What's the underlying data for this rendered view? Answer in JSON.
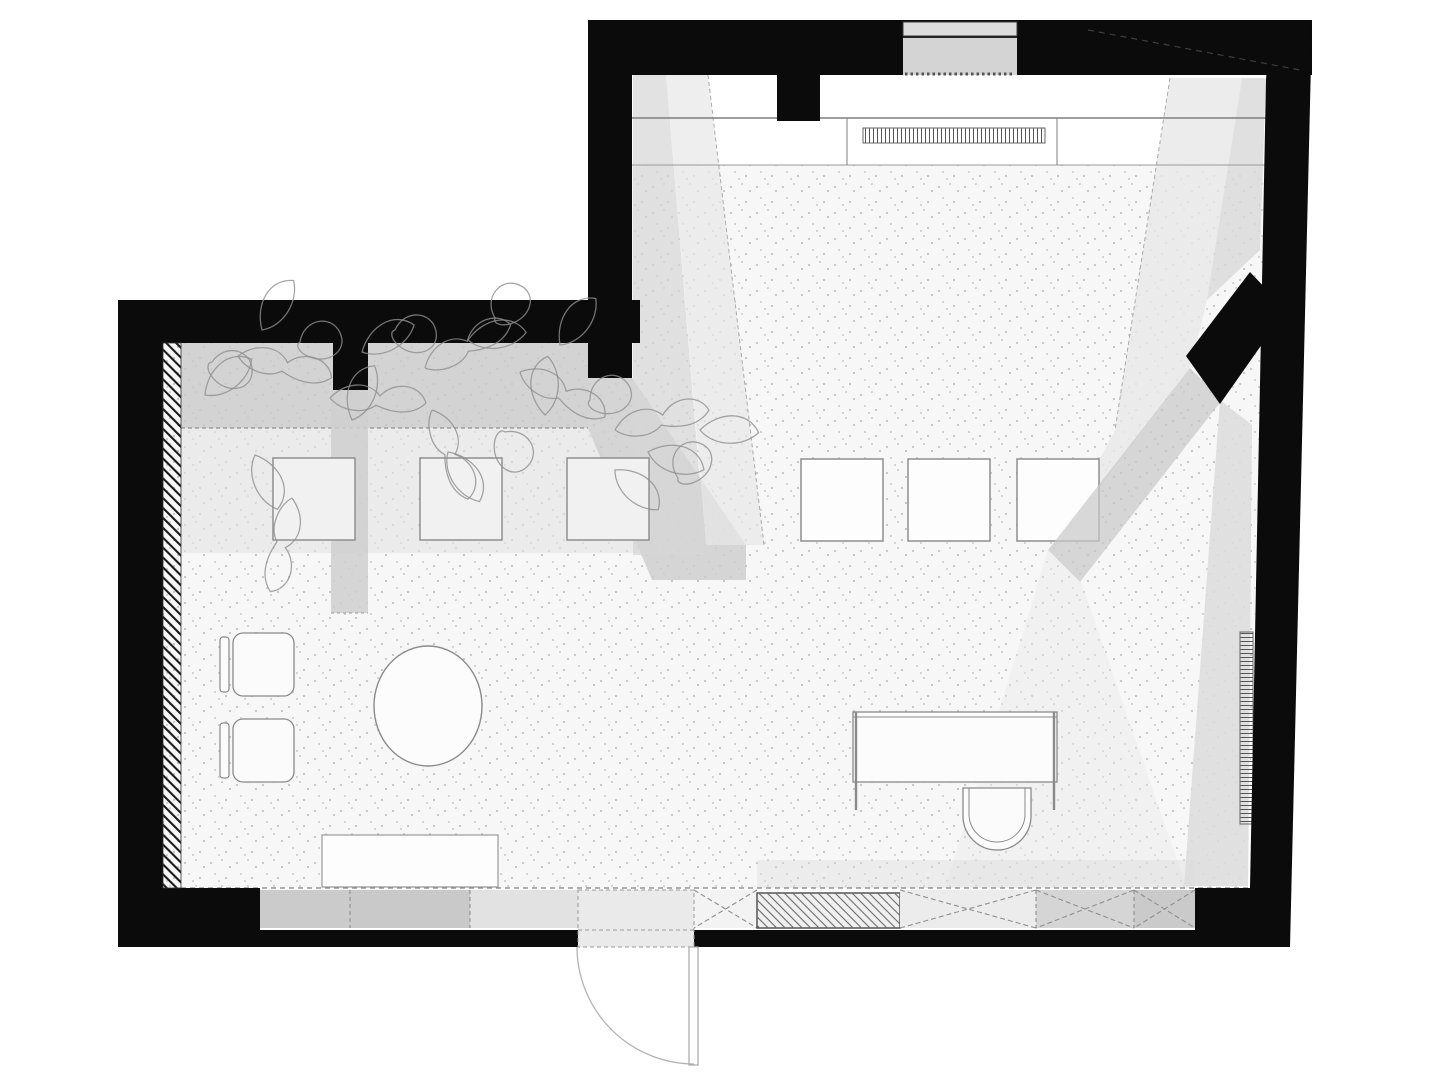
{
  "plan": {
    "title": "studio-floor-plan",
    "canvas": {
      "w": 1440,
      "h": 1080,
      "background": "#ffffff"
    },
    "colors": {
      "wall": "#0b0b0b",
      "floor_base": "#f7f7f7",
      "shadow_dark": "#c7c7c7",
      "shadow_mid": "#d5d5d5",
      "shadow_light": "#e7e7e7",
      "furniture_stroke": "#8a8a8a",
      "opening_gray": "#d4d4d4"
    },
    "leaves": {
      "shapes": {
        "leaf": "M0,0 C7,-15 24,-22 35,-11 C29,1 12,7 0,0 Z",
        "vine": "M0,0 C9,-11 23,-13 31,-4 C40,-15 56,-13 60,-2 C51,8 37,5 29,2 C21,9 7,7 0,0",
        "loop": "M0,0 C-4,-14 10,-24 20,-16 C30,-8 22,6 8,6 C2,6 -2,3 0,0 Z"
      },
      "stroke": "#8f8f8f",
      "items": [
        [
          205,
          395,
          -20,
          "leaf"
        ],
        [
          238,
          356,
          15,
          "vine"
        ],
        [
          262,
          330,
          -40,
          "leaf"
        ],
        [
          300,
          342,
          25,
          "loop"
        ],
        [
          330,
          398,
          5,
          "vine"
        ],
        [
          362,
          352,
          -10,
          "leaf"
        ],
        [
          395,
          330,
          40,
          "loop"
        ],
        [
          425,
          368,
          -25,
          "vine"
        ],
        [
          468,
          340,
          10,
          "leaf"
        ],
        [
          495,
          318,
          -15,
          "loop"
        ],
        [
          520,
          372,
          30,
          "vine"
        ],
        [
          560,
          345,
          -35,
          "leaf"
        ],
        [
          590,
          400,
          15,
          "loop"
        ],
        [
          615,
          430,
          -10,
          "vine"
        ],
        [
          648,
          452,
          35,
          "leaf"
        ],
        [
          678,
          478,
          -20,
          "loop"
        ],
        [
          255,
          455,
          85,
          "leaf"
        ],
        [
          292,
          498,
          105,
          "vine"
        ],
        [
          448,
          452,
          75,
          "leaf"
        ],
        [
          505,
          432,
          95,
          "loop"
        ],
        [
          615,
          470,
          60,
          "leaf"
        ],
        [
          700,
          430,
          20,
          "leaf"
        ],
        [
          212,
          362,
          50,
          "loop"
        ],
        [
          352,
          420,
          -50,
          "leaf"
        ],
        [
          432,
          410,
          70,
          "vine"
        ],
        [
          545,
          415,
          -70,
          "leaf"
        ]
      ]
    },
    "shapes": [
      {
        "n": "floor-base",
        "k": "poly",
        "p": "163,343 588,343 588,378 632,378 632,165 1266,165 1248,888 163,888",
        "f": "#f7f7f7"
      },
      {
        "n": "floor-stipple",
        "k": "poly",
        "p": "163,343 588,343 588,378 632,378 632,165 1266,165 1248,888 163,888",
        "f": "url(#dots)",
        "o": 0.6
      },
      {
        "n": "entry-counter-band",
        "k": "rect",
        "x": 632,
        "y": 75,
        "w": 636,
        "h": 90,
        "f": "#ffffff"
      },
      {
        "n": "shadow-left-mid-zone",
        "k": "poly",
        "p": "181,428 588,428 660,553 181,553",
        "f": "#e2e2e2",
        "o": 0.6
      },
      {
        "n": "planting-band",
        "k": "rect",
        "x": 181,
        "y": 343,
        "w": 407,
        "h": 85,
        "f": "#c9c9c9",
        "o": 0.8
      },
      {
        "n": "planting-band-tail",
        "k": "poly",
        "p": "588,378 632,378 746,545 746,580 652,580 588,428",
        "f": "#cccccc",
        "o": 0.8
      },
      {
        "n": "planting-band-edge",
        "k": "line",
        "x1": 181,
        "y1": 428,
        "x2": 588,
        "y2": 428,
        "s": "#8f8f8f",
        "sw": 1.2,
        "da": "4,3"
      },
      {
        "n": "pier-shadow",
        "k": "rect",
        "x": 331,
        "y": 390,
        "w": 37,
        "h": 223,
        "f": "#cfcfcf",
        "o": 0.85
      },
      {
        "n": "pier-shadow-edge",
        "k": "line",
        "x1": 331,
        "y1": 613,
        "x2": 368,
        "y2": 613,
        "s": "#999999",
        "sw": 1,
        "da": "3,3"
      },
      {
        "n": "light-band-left-dark",
        "k": "poly",
        "p": "633,75 666,75 706,555 633,555",
        "f": "#d5d5d5",
        "o": 0.7
      },
      {
        "n": "light-band-left",
        "k": "poly",
        "p": "666,75 708,75 764,545 706,545",
        "f": "#e7e7e7",
        "o": 0.7
      },
      {
        "n": "light-band-left-edge",
        "k": "line",
        "x1": 708,
        "y1": 75,
        "x2": 764,
        "y2": 545,
        "s": "#aaaaaa",
        "sw": 1,
        "da": "4,3"
      },
      {
        "n": "light-band-right",
        "k": "poly",
        "p": "1170,78 1242,78 1207,300 1190,368 1052,550 1115,430",
        "f": "#e7e7e7",
        "o": 0.8
      },
      {
        "n": "light-band-right-edge",
        "k": "line",
        "x1": 1170,
        "y1": 78,
        "x2": 1115,
        "y2": 430,
        "s": "#aaaaaa",
        "sw": 1,
        "da": "4,3"
      },
      {
        "n": "shadow-band-right-wall",
        "k": "poly",
        "p": "1242,78 1266,78 1260,250 1207,300",
        "f": "#d8d8d8",
        "o": 0.8
      },
      {
        "n": "shadow-right-lower",
        "k": "poly",
        "p": "1220,400 1252,425 1248,886 1184,886",
        "f": "#dcdcdc",
        "o": 0.85
      },
      {
        "n": "light-spill-bottom-right",
        "k": "poly",
        "p": "1048,550 1082,584 1186,886 946,886",
        "f": "#e9e9e9",
        "o": 0.45
      },
      {
        "n": "shadow-bottom-strip",
        "k": "rect",
        "x": 757,
        "y": 860,
        "w": 438,
        "h": 28,
        "f": "#dcdcdc",
        "o": 0.4
      },
      {
        "n": "counter-front-line",
        "k": "line",
        "x1": 632,
        "y1": 118,
        "x2": 1268,
        "y2": 118,
        "s": "#7e7e7e",
        "sw": 1.6
      },
      {
        "n": "floor-start-line",
        "k": "line",
        "x1": 632,
        "y1": 165,
        "x2": 1266,
        "y2": 165,
        "s": "#9a9a9a",
        "sw": 1.1
      },
      {
        "n": "counter-divider-left",
        "k": "line",
        "x1": 847,
        "y1": 118,
        "x2": 847,
        "y2": 165,
        "s": "#8a8a8a",
        "sw": 1.1
      },
      {
        "n": "counter-divider-right",
        "k": "line",
        "x1": 1057,
        "y1": 118,
        "x2": 1057,
        "y2": 165,
        "s": "#8a8a8a",
        "sw": 1.1
      },
      {
        "n": "radiator-top",
        "k": "rect",
        "x": 863,
        "y": 128,
        "w": 182,
        "h": 15,
        "f": "url(#vlines)",
        "s": "#666666",
        "sw": 1
      },
      {
        "n": "floor-edge-dashed",
        "k": "line",
        "x1": 181,
        "y1": 888,
        "x2": 1248,
        "y2": 888,
        "s": "#808080",
        "sw": 1.2,
        "da": "5,4"
      },
      {
        "n": "table-left-1",
        "k": "rect",
        "x": 273,
        "y": 458,
        "w": 82,
        "h": 82,
        "f": "#f1f1f1",
        "s": "#8f8f8f",
        "sw": 1.5
      },
      {
        "n": "table-left-2",
        "k": "rect",
        "x": 420,
        "y": 458,
        "w": 82,
        "h": 82,
        "f": "#f1f1f1",
        "s": "#8f8f8f",
        "sw": 1.5
      },
      {
        "n": "table-left-3",
        "k": "rect",
        "x": 567,
        "y": 458,
        "w": 82,
        "h": 82,
        "f": "#f1f1f1",
        "s": "#8f8f8f",
        "sw": 1.5
      },
      {
        "n": "table-right-1",
        "k": "rect",
        "x": 801,
        "y": 459,
        "w": 82,
        "h": 82,
        "f": "#fdfdfd",
        "s": "#8f8f8f",
        "sw": 1.5
      },
      {
        "n": "table-right-2",
        "k": "rect",
        "x": 908,
        "y": 459,
        "w": 82,
        "h": 82,
        "f": "#fdfdfd",
        "s": "#8f8f8f",
        "sw": 1.5
      },
      {
        "n": "table-right-3",
        "k": "rect",
        "x": 1017,
        "y": 459,
        "w": 82,
        "h": 82,
        "f": "#fdfdfd",
        "s": "#8f8f8f",
        "sw": 1.5
      },
      {
        "n": "pillar-shadow-diagonal",
        "k": "poly",
        "p": "1190,368 1222,400 1080,582 1048,550",
        "f": "#c7c7c7",
        "o": 0.7
      },
      {
        "n": "round-table",
        "k": "ellipse",
        "cx": 428,
        "cy": 706,
        "rx": 54,
        "ry": 60,
        "f": "#fcfcfc",
        "s": "#8a8a8a",
        "sw": 1.4
      },
      {
        "n": "armchair-1-back",
        "k": "rect",
        "x": 220,
        "y": 637,
        "w": 9,
        "h": 55,
        "rx": 3,
        "f": "#fbfbfb",
        "s": "#8a8a8a",
        "sw": 1.2
      },
      {
        "n": "armchair-1-seat",
        "k": "rect",
        "x": 233,
        "y": 633,
        "w": 61,
        "h": 63,
        "rx": 10,
        "f": "#fbfbfb",
        "s": "#8a8a8a",
        "sw": 1.3
      },
      {
        "n": "armchair-2-back",
        "k": "rect",
        "x": 220,
        "y": 723,
        "w": 9,
        "h": 55,
        "rx": 3,
        "f": "#fbfbfb",
        "s": "#8a8a8a",
        "sw": 1.2
      },
      {
        "n": "armchair-2-seat",
        "k": "rect",
        "x": 233,
        "y": 719,
        "w": 61,
        "h": 63,
        "rx": 10,
        "f": "#fbfbfb",
        "s": "#8a8a8a",
        "sw": 1.3
      },
      {
        "n": "bench",
        "k": "rect",
        "x": 322,
        "y": 835,
        "w": 176,
        "h": 52,
        "f": "#fdfdfd",
        "s": "#999999",
        "sw": 1.2
      },
      {
        "n": "desk-top",
        "k": "rect",
        "x": 853,
        "y": 712,
        "w": 204,
        "h": 70,
        "f": "#fcfcfc",
        "s": "#8a8a8a",
        "sw": 1.3
      },
      {
        "n": "desk-top-edge",
        "k": "line",
        "x1": 853,
        "y1": 717,
        "x2": 1057,
        "y2": 717,
        "s": "#8a8a8a",
        "sw": 1
      },
      {
        "n": "desk-leg-left",
        "k": "line",
        "x1": 856,
        "y1": 712,
        "x2": 856,
        "y2": 810,
        "s": "#8a8a8a",
        "sw": 2.4
      },
      {
        "n": "desk-leg-right",
        "k": "line",
        "x1": 1054,
        "y1": 712,
        "x2": 1054,
        "y2": 810,
        "s": "#8a8a8a",
        "sw": 2.4
      },
      {
        "n": "desk-chair-outer",
        "k": "path",
        "d": "M963,788 L1031,788 L1031,816 A34,34 0 0 1 963,816 Z",
        "f": "#fbfbfb",
        "s": "#8a8a8a",
        "sw": 1.3
      },
      {
        "n": "desk-chair-inner",
        "k": "path",
        "d": "M969,788 L1025,788 L1025,814 A28,28 0 0 1 969,814 Z",
        "f": "none",
        "s": "#8a8a8a",
        "sw": 1
      },
      {
        "n": "radiator-right",
        "k": "rect",
        "x": 1240,
        "y": 632,
        "w": 13,
        "h": 192,
        "f": "url(#hlines)",
        "s": "#666666",
        "sw": 1
      },
      {
        "n": "wall-top",
        "k": "rect",
        "x": 588,
        "y": 20,
        "w": 724,
        "h": 55,
        "f": "#0b0b0b"
      },
      {
        "n": "wall-upper-left",
        "k": "rect",
        "x": 588,
        "y": 20,
        "w": 44,
        "h": 358,
        "f": "#0b0b0b"
      },
      {
        "n": "wall-top-pier",
        "k": "rect",
        "x": 777,
        "y": 75,
        "w": 43,
        "h": 46,
        "f": "#0b0b0b"
      },
      {
        "n": "wall-left-room-top",
        "k": "rect",
        "x": 118,
        "y": 300,
        "w": 522,
        "h": 43,
        "f": "#0b0b0b"
      },
      {
        "n": "wall-left",
        "k": "rect",
        "x": 118,
        "y": 300,
        "w": 45,
        "h": 647,
        "f": "#0b0b0b"
      },
      {
        "n": "wall-bottom-left-corner",
        "k": "rect",
        "x": 118,
        "y": 888,
        "w": 142,
        "h": 59,
        "f": "#0b0b0b"
      },
      {
        "n": "wall-bottom-west",
        "k": "rect",
        "x": 260,
        "y": 930,
        "w": 318,
        "h": 17,
        "f": "#0b0b0b"
      },
      {
        "n": "wall-bottom-east",
        "k": "rect",
        "x": 694,
        "y": 930,
        "w": 501,
        "h": 17,
        "f": "#0b0b0b"
      },
      {
        "n": "wall-bottom-right-corner",
        "k": "rect",
        "x": 1195,
        "y": 888,
        "w": 95,
        "h": 59,
        "f": "#0b0b0b"
      },
      {
        "n": "wall-right",
        "k": "poly",
        "p": "1270,20 1312,20 1290,947 1250,947 1250,888 1266,80",
        "f": "#0b0b0b"
      },
      {
        "n": "wall-left-room-pier",
        "k": "rect",
        "x": 333,
        "y": 343,
        "w": 35,
        "h": 47,
        "f": "#0b0b0b"
      },
      {
        "n": "wall-diagonal-pillar",
        "k": "poly",
        "p": "1186,356 1250,272 1286,310 1220,404",
        "f": "#0b0b0b"
      },
      {
        "n": "roof-line-hidden",
        "k": "line",
        "x1": 1088,
        "y1": 30,
        "x2": 1300,
        "y2": 70,
        "s": "#3d3d3d",
        "sw": 1.2,
        "da": "6,5"
      },
      {
        "n": "entry-opening-outer",
        "k": "rect",
        "x": 903,
        "y": 22,
        "w": 114,
        "h": 14,
        "f": "#dcdcdc",
        "s": "#3a3a3a",
        "sw": 1
      },
      {
        "n": "entry-opening-inner",
        "k": "rect",
        "x": 903,
        "y": 37,
        "w": 114,
        "h": 38,
        "f": "#d4d4d4"
      },
      {
        "n": "entry-opening-line",
        "k": "line",
        "x1": 903,
        "y1": 37,
        "x2": 1017,
        "y2": 37,
        "s": "#222222",
        "sw": 2
      },
      {
        "n": "entry-threshold-dots",
        "k": "line",
        "x1": 905,
        "y1": 74,
        "x2": 1014,
        "y2": 74,
        "s": "#555555",
        "sw": 3,
        "da": "2.5,3"
      },
      {
        "n": "wall-finish-hatch",
        "k": "rect",
        "x": 163,
        "y": 343,
        "w": 18,
        "h": 545,
        "f": "url(#hatchL)",
        "s": "#333333",
        "sw": 0.8
      },
      {
        "n": "sill-segment-1",
        "k": "rect",
        "x": 260,
        "y": 890,
        "w": 90,
        "h": 38,
        "f": "#cbcbcb"
      },
      {
        "n": "sill-segment-2",
        "k": "rect",
        "x": 350,
        "y": 890,
        "w": 120,
        "h": 38,
        "f": "#c9c9c9"
      },
      {
        "n": "sill-segment-3",
        "k": "rect",
        "x": 470,
        "y": 890,
        "w": 108,
        "h": 38,
        "f": "#e2e2e2"
      },
      {
        "n": "window-x-1",
        "k": "rect",
        "x": 694,
        "y": 890,
        "w": 63,
        "h": 38,
        "f": "#f3f3f3"
      },
      {
        "n": "window-x-1-a",
        "k": "line",
        "x1": 694,
        "y1": 890,
        "x2": 757,
        "y2": 928,
        "s": "#8f8f8f",
        "sw": 1.1,
        "da": "5,3"
      },
      {
        "n": "window-x-1-b",
        "k": "line",
        "x1": 757,
        "y1": 890,
        "x2": 694,
        "y2": 928,
        "s": "#8f8f8f",
        "sw": 1.1,
        "da": "5,3"
      },
      {
        "n": "masonry-infill-bg",
        "k": "rect",
        "x": 757,
        "y": 893,
        "w": 143,
        "h": 35,
        "f": "#f0f0f0",
        "s": "#4a4a4a",
        "sw": 1.4
      },
      {
        "n": "masonry-infill-hatch",
        "k": "rect",
        "x": 757,
        "y": 893,
        "w": 143,
        "h": 35,
        "f": "url(#masonry)"
      },
      {
        "n": "window-x-2",
        "k": "rect",
        "x": 900,
        "y": 890,
        "w": 136,
        "h": 38,
        "f": "#ececec"
      },
      {
        "n": "window-x-2-a",
        "k": "line",
        "x1": 900,
        "y1": 890,
        "x2": 1036,
        "y2": 928,
        "s": "#8f8f8f",
        "sw": 1.1,
        "da": "5,3"
      },
      {
        "n": "window-x-2-b",
        "k": "line",
        "x1": 1036,
        "y1": 890,
        "x2": 900,
        "y2": 928,
        "s": "#8f8f8f",
        "sw": 1.1,
        "da": "5,3"
      },
      {
        "n": "window-x-3",
        "k": "rect",
        "x": 1036,
        "y": 890,
        "w": 98,
        "h": 38,
        "f": "#d5d5d5"
      },
      {
        "n": "window-x-3-a",
        "k": "line",
        "x1": 1036,
        "y1": 890,
        "x2": 1134,
        "y2": 928,
        "s": "#8f8f8f",
        "sw": 1.1,
        "da": "5,3"
      },
      {
        "n": "window-x-3-b",
        "k": "line",
        "x1": 1134,
        "y1": 890,
        "x2": 1036,
        "y2": 928,
        "s": "#8f8f8f",
        "sw": 1.1,
        "da": "5,3"
      },
      {
        "n": "window-x-4",
        "k": "rect",
        "x": 1134,
        "y": 890,
        "w": 61,
        "h": 38,
        "f": "#cacaca"
      },
      {
        "n": "window-x-4-a",
        "k": "line",
        "x1": 1134,
        "y1": 890,
        "x2": 1195,
        "y2": 928,
        "s": "#8f8f8f",
        "sw": 1.1,
        "da": "5,3"
      },
      {
        "n": "window-x-4-b",
        "k": "line",
        "x1": 1195,
        "y1": 890,
        "x2": 1134,
        "y2": 928,
        "s": "#8f8f8f",
        "sw": 1.1,
        "da": "5,3"
      },
      {
        "n": "sill-divider-1",
        "k": "line",
        "x1": 350,
        "y1": 890,
        "x2": 350,
        "y2": 928,
        "s": "#888888",
        "sw": 1,
        "da": "4,3"
      },
      {
        "n": "sill-divider-2",
        "k": "line",
        "x1": 470,
        "y1": 890,
        "x2": 470,
        "y2": 928,
        "s": "#888888",
        "sw": 1,
        "da": "4,3"
      },
      {
        "n": "sill-divider-3",
        "k": "line",
        "x1": 1036,
        "y1": 890,
        "x2": 1036,
        "y2": 928,
        "s": "#888888",
        "sw": 1,
        "da": "4,3"
      },
      {
        "n": "sill-divider-4",
        "k": "line",
        "x1": 1134,
        "y1": 890,
        "x2": 1134,
        "y2": 928,
        "s": "#888888",
        "sw": 1,
        "da": "4,3"
      },
      {
        "n": "door-opening",
        "k": "rect",
        "x": 578,
        "y": 890,
        "w": 116,
        "h": 57,
        "f": "#eaeaea",
        "s": "#9a9a9a",
        "sw": 1,
        "da": "4,3"
      },
      {
        "n": "door-opening-line",
        "k": "line",
        "x1": 578,
        "y1": 930,
        "x2": 694,
        "y2": 930,
        "s": "#9a9a9a",
        "sw": 1,
        "da": "4,3"
      },
      {
        "n": "door-leaf",
        "k": "rect",
        "x": 689,
        "y": 947,
        "w": 9,
        "h": 118,
        "f": "#ffffff",
        "s": "#a8a8a8",
        "sw": 1.2
      },
      {
        "n": "door-swing-arc",
        "k": "path",
        "d": "M577,947 A117.5,117.5 0 0 0 694,1064",
        "f": "none",
        "s": "#b3b3b3",
        "sw": 1.3
      }
    ]
  }
}
